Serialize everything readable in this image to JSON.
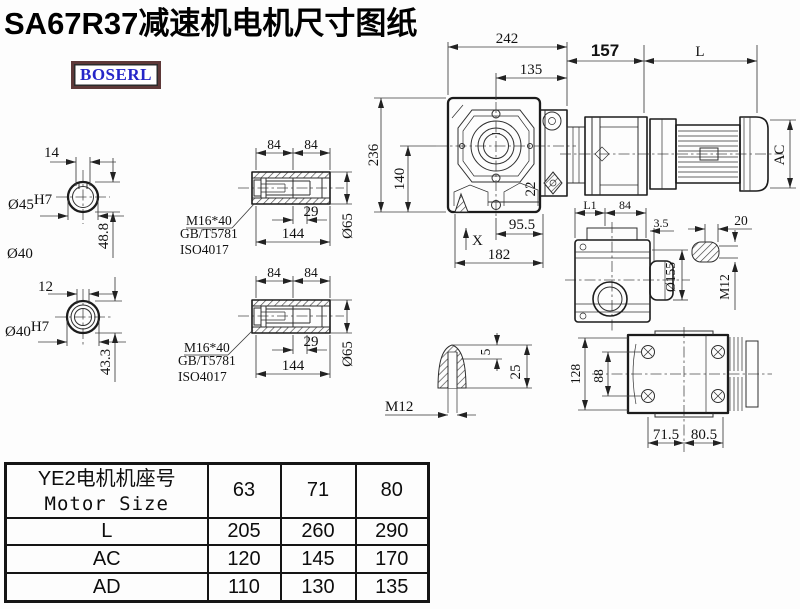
{
  "title": "SA67R37减速机电机尺寸图纸",
  "brand": {
    "logo_text": "BOSERL",
    "logo_text_color": "#2626c8",
    "logo_border_color": "#5d3838"
  },
  "views": {
    "shaft_hole_a": {
      "key_width": "14",
      "bore": "Ø45",
      "fit": "H7",
      "depth": "48.8",
      "outer": "Ø40"
    },
    "shaft_hole_b": {
      "key_width": "12",
      "bore": "Ø40",
      "fit": "H7",
      "depth": "43.3"
    },
    "hollow_shaft_a": {
      "len1": "84",
      "len2": "84",
      "screw": "M16*40",
      "std1": "GB/T5781",
      "std2": "ISO4017",
      "key_len": "29",
      "total_len": "144",
      "dia": "Ø65"
    },
    "hollow_shaft_b": {
      "len1": "84",
      "len2": "84",
      "screw": "M16*40",
      "std1": "GB/T5781",
      "std2": "ISO4017",
      "key_len": "29",
      "total_len": "144",
      "dia": "Ø65"
    },
    "front": {
      "width": "242",
      "to_center": "135",
      "adapter": "157",
      "motor_len": "L",
      "height": "236",
      "center_h": "140",
      "bolt": "22",
      "foot1": "95.5",
      "foot2": "182",
      "x_mark": "X",
      "motor_dia": "AC"
    },
    "side": {
      "l1": "L1",
      "w84": "84",
      "w35": "3.5",
      "key20": "20",
      "flange": "Ø155",
      "tap": "M12"
    },
    "plug": {
      "d5": "5",
      "d25": "25",
      "tap": "M12"
    },
    "top": {
      "h128": "128",
      "h88": "88",
      "f715": "71.5",
      "f805": "80.5"
    }
  },
  "table": {
    "header_cn": "YE2电机机座号",
    "header_en": "Motor Size",
    "sizes": [
      "63",
      "71",
      "80"
    ],
    "rows": [
      {
        "label": "L",
        "values": [
          "205",
          "260",
          "290"
        ]
      },
      {
        "label": "AC",
        "values": [
          "120",
          "145",
          "170"
        ]
      },
      {
        "label": "AD",
        "values": [
          "110",
          "130",
          "135"
        ]
      }
    ]
  }
}
